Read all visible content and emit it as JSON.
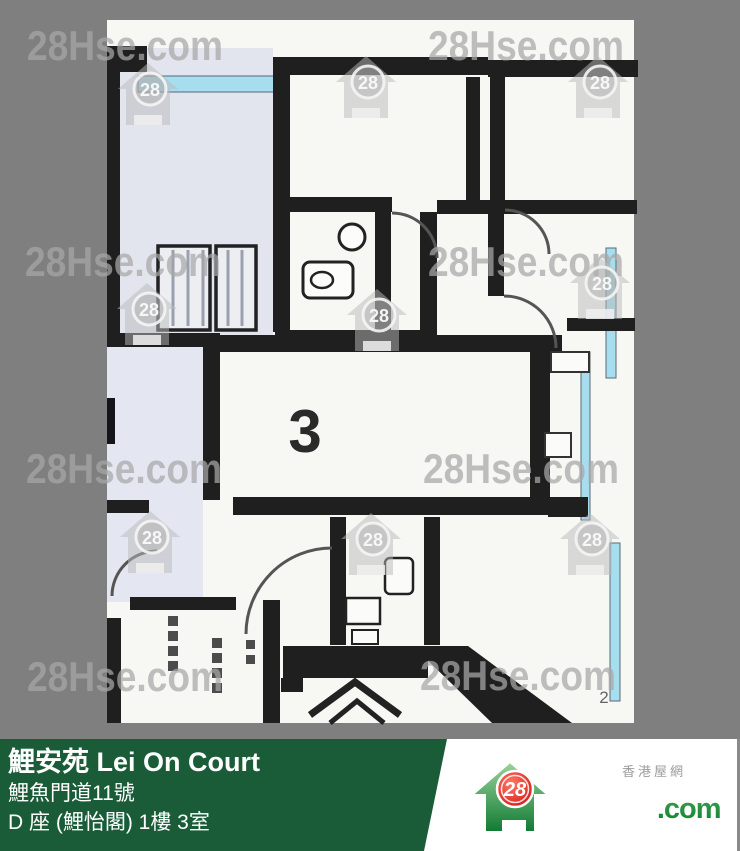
{
  "photo": {
    "watermark_text": "28Hse.com",
    "watermark_badge": "28",
    "unit_label": "3",
    "corner_mark": "2"
  },
  "banner": {
    "title": "鯉安苑 Lei On Court",
    "address": "鯉魚門道11號",
    "unit": "D 座 (鯉怡閣) 1樓 3室"
  },
  "logo": {
    "badge": "28",
    "brand": "28Hse",
    "suffix": ".com",
    "tagline": "香港屋網"
  },
  "colors": {
    "background_gray": "#7f7f7f",
    "banner_green": "#1a5c38",
    "brand_green": "#15853a",
    "badge_red": "#e01b1b",
    "window_cyan": "#a6ddef",
    "wall_black": "#1f1f1f"
  }
}
